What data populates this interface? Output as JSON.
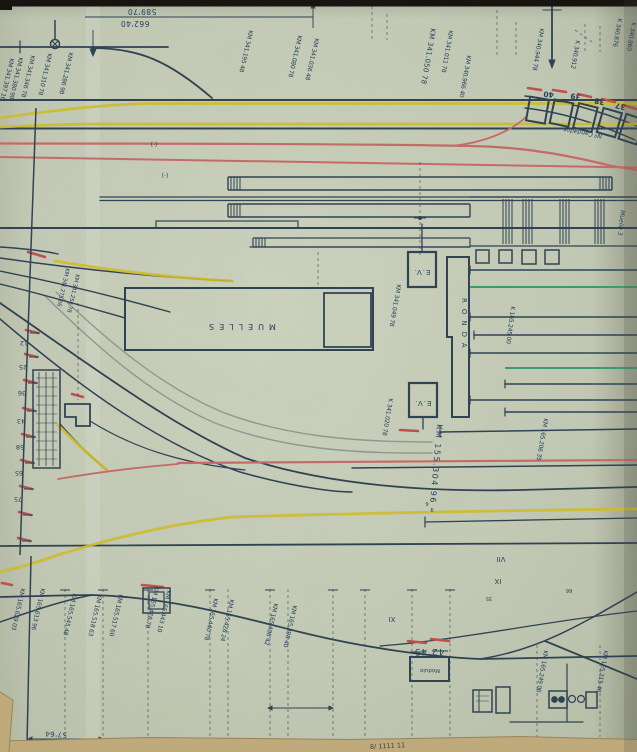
{
  "plan": {
    "top_dimensions": {
      "upper": "589'70",
      "lower": "662'40"
    },
    "buildings": {
      "muelles": "MUELLES",
      "ronda": "RONDA",
      "ev_upper": "E.V.",
      "ev_lower": "E.V."
    },
    "top_labels": [
      "KM 341.397 16",
      "KM 341.380 98",
      "KM 341.346 78",
      "KM 341.310 78",
      "KM 341.286 98",
      "KM 341.195 48",
      "KM 341.080 78",
      "KM 341.036 48",
      "KM 341.050 78",
      "KM 341.011 78",
      "KM 340.966 40",
      "KM 340.944 78",
      "K 340.912",
      "K 340.876",
      "K 340.860"
    ],
    "mid_labels": [
      "KM 341.275 06",
      "KM 341.256 78",
      "K 341.020 78",
      "KM 341.049 78",
      "K 165.245 00",
      "KM 155.304 96",
      "KM 165.206 35",
      "Muelle 3"
    ],
    "bottom_labels": [
      "KM 165.629 03",
      "KM 165.613 96",
      "KM 165.545 48",
      "KM 165.518 63",
      "KM 165.517 60",
      "KM 165.478 78",
      "KM 165.443 10",
      "KM 165.440 78",
      "KM 165.428 24",
      "KM 165.408 42",
      "KM 165.398 40",
      "KM 165.249 06",
      "KM 165.215 46"
    ],
    "boundary_numbers": [
      "12",
      "25",
      "36",
      "43",
      "58",
      "65",
      "75"
    ],
    "wagon_box_numbers": [
      "40",
      "39",
      "38",
      "37"
    ],
    "box_chain_note": "Nº Candados",
    "roman_numerals": [
      "VII",
      "IX",
      "XI"
    ],
    "annotations": {
      "pair_42_45": "42 45",
      "modulo": "Módulo",
      "dim_57_64": "57'64",
      "tiny_6": "6",
      "tiny_9": "9",
      "tiny_35": "35",
      "tiny_66": "66",
      "paren_mark": "(·)",
      "edge_note": "8/ 1111 11"
    },
    "colors": {
      "track": "#2e4254",
      "yellow": "#d2c02c",
      "red": "#c96b6b",
      "green": "#3a9d79",
      "paper": "#c7ceba",
      "ink": "#24405c"
    }
  }
}
